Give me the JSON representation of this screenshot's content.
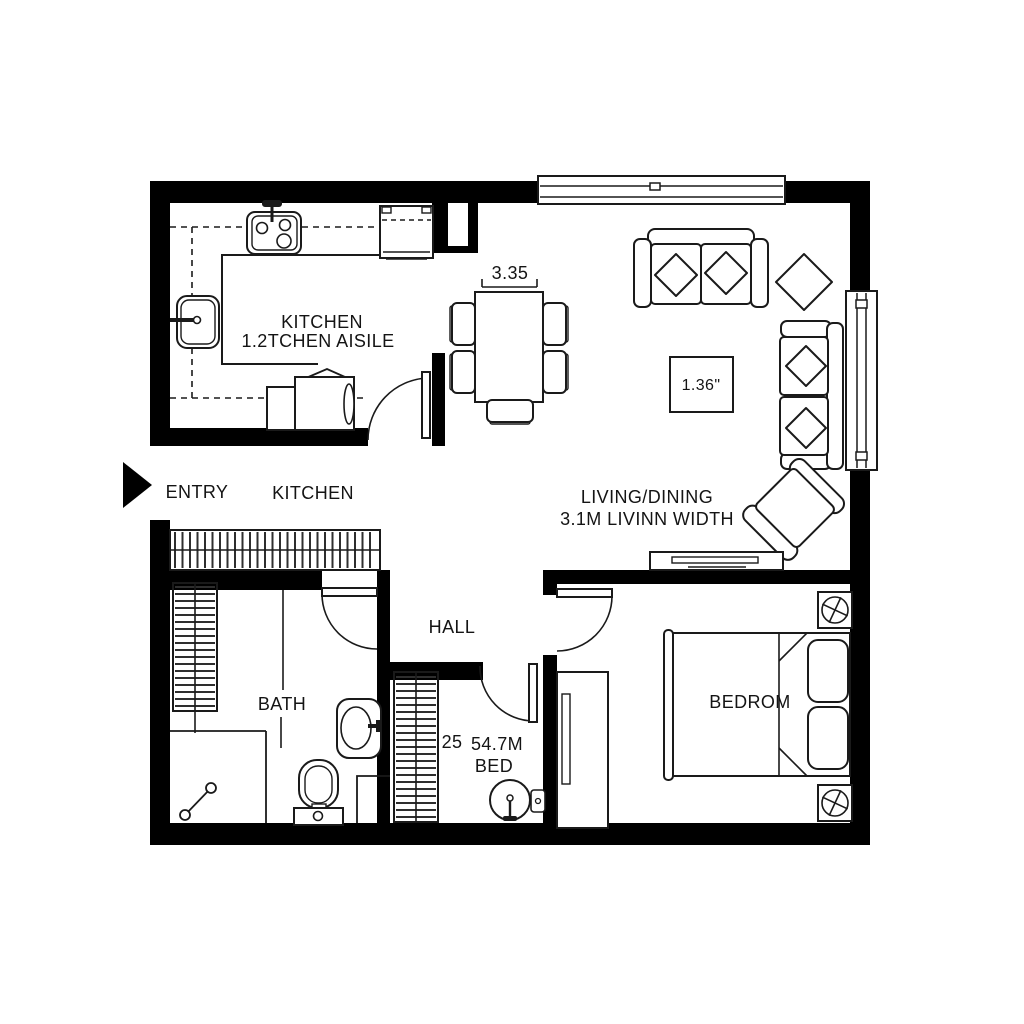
{
  "title": "apartment-floor-plan",
  "colors": {
    "wall": "#000000",
    "line": "#1a1a1a",
    "background": "#ffffff"
  },
  "labels": {
    "kitchen_title": "KITCHEN",
    "kitchen_sub": "1.2TCHEN AISILE",
    "dining_width": "3.35",
    "coffee_table": "1.36\"",
    "living_title": "LIVING/DINING",
    "living_sub": "3.1M LIVINN WIDTH",
    "entry": "ENTRY",
    "entry_kitchen": "KITCHEN",
    "hall": "HALL",
    "bath": "BATH",
    "wc_number": "25",
    "wc_area": "54.7M",
    "wc_bed": "BED",
    "bedroom": "BEDROM"
  }
}
